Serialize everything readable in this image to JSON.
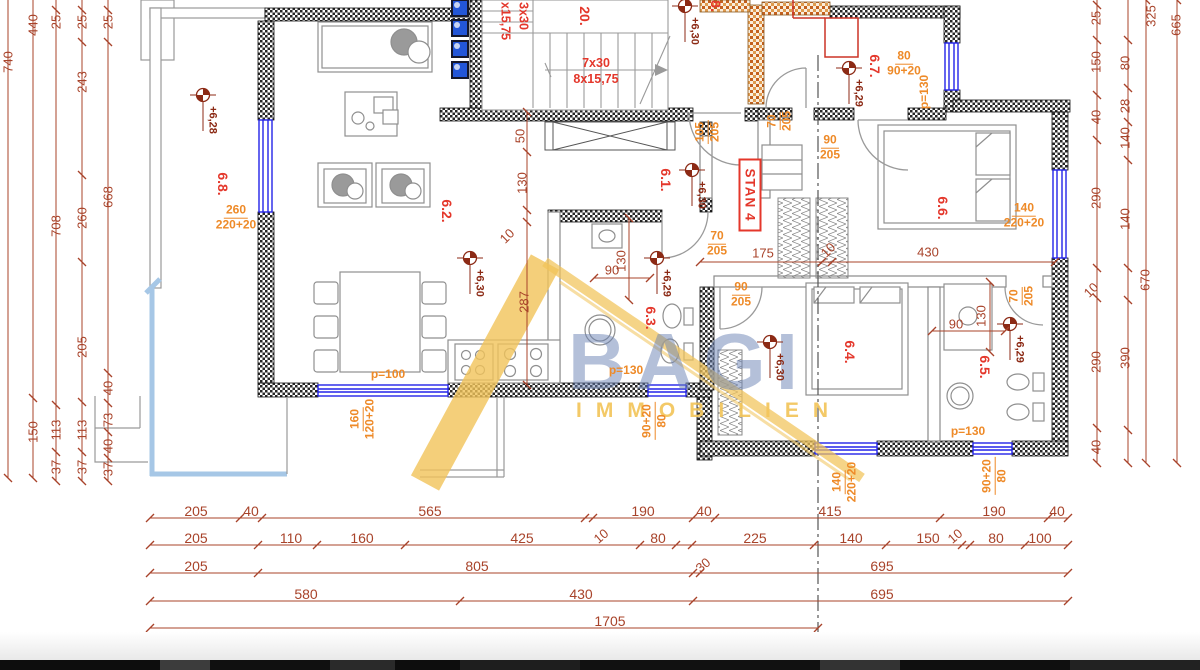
{
  "watermark": {
    "line1": "BAGI",
    "line2": "IMMOBILIEN"
  },
  "apartment_badge": "STAN 4",
  "colors": {
    "dimension": "#a8432a",
    "room_label": "#e4372b",
    "opening_label": "#ee8a28",
    "elevation": "#8c2a15",
    "window": "#2323e8",
    "terrace_edge": "#a6c7e6",
    "watermark_yellow": "#f2c45a",
    "watermark_blue": "#6982b4"
  },
  "plan": {
    "labels": [
      {
        "t": "740",
        "x": 8,
        "y": 62,
        "r": -90,
        "c": "d"
      },
      {
        "t": "440",
        "x": 33,
        "y": 25,
        "r": -90,
        "c": "d"
      },
      {
        "t": "150",
        "x": 33,
        "y": 432,
        "r": -90,
        "c": "d"
      },
      {
        "t": "25",
        "x": 56,
        "y": 22,
        "r": -90,
        "c": "d"
      },
      {
        "t": "708",
        "x": 56,
        "y": 226,
        "r": -90,
        "c": "d"
      },
      {
        "t": "113",
        "x": 56,
        "y": 430,
        "r": -90,
        "c": "d"
      },
      {
        "t": "37",
        "x": 56,
        "y": 467,
        "r": -90,
        "c": "d"
      },
      {
        "t": "25",
        "x": 82,
        "y": 22,
        "r": -90,
        "c": "d"
      },
      {
        "t": "243",
        "x": 82,
        "y": 82,
        "r": -90,
        "c": "d"
      },
      {
        "t": "260",
        "x": 82,
        "y": 218,
        "r": -90,
        "c": "d"
      },
      {
        "t": "205",
        "x": 82,
        "y": 347,
        "r": -90,
        "c": "d"
      },
      {
        "t": "113",
        "x": 82,
        "y": 430,
        "r": -90,
        "c": "d"
      },
      {
        "t": "37",
        "x": 82,
        "y": 467,
        "r": -90,
        "c": "d"
      },
      {
        "t": "25",
        "x": 108,
        "y": 22,
        "r": -90,
        "c": "d"
      },
      {
        "t": "668",
        "x": 108,
        "y": 197,
        "r": -90,
        "c": "d"
      },
      {
        "t": "40",
        "x": 108,
        "y": 388,
        "r": -90,
        "c": "d"
      },
      {
        "t": "73",
        "x": 108,
        "y": 420,
        "r": -90,
        "c": "d"
      },
      {
        "t": "40",
        "x": 108,
        "y": 446,
        "r": -90,
        "c": "d"
      },
      {
        "t": "37",
        "x": 108,
        "y": 469,
        "r": -90,
        "c": "d"
      },
      {
        "t": "50",
        "x": 520,
        "y": 136,
        "r": -90,
        "c": "d"
      },
      {
        "t": "130",
        "x": 522,
        "y": 183,
        "r": -90,
        "c": "d"
      },
      {
        "t": "10",
        "x": 507,
        "y": 236,
        "r": -45,
        "c": "d"
      },
      {
        "t": "287",
        "x": 524,
        "y": 302,
        "r": -90,
        "c": "d"
      },
      {
        "t": "130",
        "x": 621,
        "y": 261,
        "r": -90,
        "c": "d"
      },
      {
        "t": "90",
        "x": 612,
        "y": 270,
        "r": 0,
        "c": "d"
      },
      {
        "t": "175",
        "x": 763,
        "y": 253,
        "r": 0,
        "c": "d"
      },
      {
        "t": "10",
        "x": 828,
        "y": 250,
        "r": -45,
        "c": "d"
      },
      {
        "t": "430",
        "x": 928,
        "y": 252,
        "r": 0,
        "c": "d"
      },
      {
        "t": "90",
        "x": 956,
        "y": 324,
        "r": 0,
        "c": "d"
      },
      {
        "t": "130",
        "x": 981,
        "y": 316,
        "r": -90,
        "c": "d"
      },
      {
        "t": "25",
        "x": 1096,
        "y": 18,
        "r": -90,
        "c": "d"
      },
      {
        "t": "150",
        "x": 1096,
        "y": 62,
        "r": -90,
        "c": "d"
      },
      {
        "t": "40",
        "x": 1096,
        "y": 117,
        "r": -90,
        "c": "d"
      },
      {
        "t": "290",
        "x": 1096,
        "y": 198,
        "r": -90,
        "c": "d"
      },
      {
        "t": "10",
        "x": 1091,
        "y": 290,
        "r": -45,
        "c": "d"
      },
      {
        "t": "290",
        "x": 1096,
        "y": 362,
        "r": -90,
        "c": "d"
      },
      {
        "t": "40",
        "x": 1096,
        "y": 447,
        "r": -90,
        "c": "d"
      },
      {
        "t": "80",
        "x": 1125,
        "y": 63,
        "r": -90,
        "c": "d"
      },
      {
        "t": "28",
        "x": 1125,
        "y": 106,
        "r": -90,
        "c": "d"
      },
      {
        "t": "140",
        "x": 1125,
        "y": 138,
        "r": -90,
        "c": "d"
      },
      {
        "t": "140",
        "x": 1125,
        "y": 219,
        "r": -90,
        "c": "d"
      },
      {
        "t": "390",
        "x": 1125,
        "y": 358,
        "r": -90,
        "c": "d"
      },
      {
        "t": "325",
        "x": 1151,
        "y": 16,
        "r": -90,
        "c": "d"
      },
      {
        "t": "670",
        "x": 1145,
        "y": 280,
        "r": -90,
        "c": "d"
      },
      {
        "t": "665",
        "x": 1176,
        "y": 25,
        "r": -90,
        "c": "d"
      },
      {
        "t": "205",
        "x": 196,
        "y": 511,
        "r": 0,
        "c": "d",
        "f": 14
      },
      {
        "t": "40",
        "x": 251,
        "y": 511,
        "r": 0,
        "c": "d",
        "f": 14
      },
      {
        "t": "565",
        "x": 430,
        "y": 511,
        "r": 0,
        "c": "d",
        "f": 14
      },
      {
        "t": "190",
        "x": 643,
        "y": 511,
        "r": 0,
        "c": "d",
        "f": 14
      },
      {
        "t": "40",
        "x": 704,
        "y": 511,
        "r": 0,
        "c": "d",
        "f": 14
      },
      {
        "t": "415",
        "x": 830,
        "y": 511,
        "r": 0,
        "c": "d",
        "f": 14
      },
      {
        "t": "190",
        "x": 994,
        "y": 511,
        "r": 0,
        "c": "d",
        "f": 14
      },
      {
        "t": "40",
        "x": 1057,
        "y": 511,
        "r": 0,
        "c": "d",
        "f": 14
      },
      {
        "t": "10",
        "x": 601,
        "y": 536,
        "r": -40,
        "c": "d"
      },
      {
        "t": "205",
        "x": 196,
        "y": 538,
        "r": 0,
        "c": "d",
        "f": 14
      },
      {
        "t": "110",
        "x": 291,
        "y": 538,
        "r": 0,
        "c": "d",
        "f": 14
      },
      {
        "t": "160",
        "x": 362,
        "y": 538,
        "r": 0,
        "c": "d",
        "f": 14
      },
      {
        "t": "425",
        "x": 522,
        "y": 538,
        "r": 0,
        "c": "d",
        "f": 14
      },
      {
        "t": "80",
        "x": 658,
        "y": 538,
        "r": 0,
        "c": "d",
        "f": 14
      },
      {
        "t": "225",
        "x": 755,
        "y": 538,
        "r": 0,
        "c": "d",
        "f": 14
      },
      {
        "t": "140",
        "x": 851,
        "y": 538,
        "r": 0,
        "c": "d",
        "f": 14
      },
      {
        "t": "150",
        "x": 928,
        "y": 538,
        "r": 0,
        "c": "d",
        "f": 14
      },
      {
        "t": "80",
        "x": 996,
        "y": 538,
        "r": 0,
        "c": "d",
        "f": 14
      },
      {
        "t": "100",
        "x": 1040,
        "y": 538,
        "r": 0,
        "c": "d",
        "f": 14
      },
      {
        "t": "30",
        "x": 703,
        "y": 565,
        "r": -40,
        "c": "d"
      },
      {
        "t": "10",
        "x": 955,
        "y": 536,
        "r": -40,
        "c": "d"
      },
      {
        "t": "205",
        "x": 196,
        "y": 566,
        "r": 0,
        "c": "d",
        "f": 14
      },
      {
        "t": "805",
        "x": 477,
        "y": 566,
        "r": 0,
        "c": "d",
        "f": 14
      },
      {
        "t": "695",
        "x": 882,
        "y": 566,
        "r": 0,
        "c": "d",
        "f": 14
      },
      {
        "t": "580",
        "x": 306,
        "y": 594,
        "r": 0,
        "c": "d",
        "f": 14
      },
      {
        "t": "430",
        "x": 581,
        "y": 594,
        "r": 0,
        "c": "d",
        "f": 14
      },
      {
        "t": "695",
        "x": 882,
        "y": 594,
        "r": 0,
        "c": "d",
        "f": 14
      },
      {
        "t": "1705",
        "x": 610,
        "y": 621,
        "r": 0,
        "c": "d",
        "f": 14
      },
      {
        "t": "6.8.",
        "x": 223,
        "y": 184,
        "r": 90,
        "c": "r"
      },
      {
        "t": "6.2.",
        "x": 447,
        "y": 211,
        "r": 90,
        "c": "r"
      },
      {
        "t": "6.3.",
        "x": 651,
        "y": 318,
        "r": 90,
        "c": "r"
      },
      {
        "t": "6.1.",
        "x": 666,
        "y": 180,
        "r": 90,
        "c": "r"
      },
      {
        "t": "6.7.",
        "x": 875,
        "y": 66,
        "r": 90,
        "c": "r"
      },
      {
        "t": "6.6.",
        "x": 943,
        "y": 208,
        "r": 90,
        "c": "r"
      },
      {
        "t": "6.4.",
        "x": 850,
        "y": 352,
        "r": 90,
        "c": "r"
      },
      {
        "t": "6.5.",
        "x": 985,
        "y": 367,
        "r": 90,
        "c": "r"
      },
      {
        "t": "20.",
        "x": 585,
        "y": 16,
        "r": 90,
        "c": "r"
      },
      {
        "t": "8.",
        "x": 716,
        "y": 6,
        "r": 90,
        "c": "r"
      },
      {
        "t": "7x30",
        "x": 596,
        "y": 63,
        "r": 0,
        "c": "r",
        "f": 12.5
      },
      {
        "t": "8x15,75",
        "x": 596,
        "y": 79,
        "r": 0,
        "c": "r",
        "f": 12.5
      },
      {
        "t": "3x30",
        "x": 523,
        "y": 16,
        "r": 90,
        "c": "r",
        "f": 12.5
      },
      {
        "t": "x15,75",
        "x": 505,
        "y": 21,
        "r": 90,
        "c": "r",
        "f": 12.5
      },
      {
        "t": "p=100",
        "x": 388,
        "y": 374,
        "r": 0,
        "c": "o"
      },
      {
        "t": "p=130",
        "x": 626,
        "y": 370,
        "r": 0,
        "c": "o"
      },
      {
        "t": "p=130",
        "x": 968,
        "y": 431,
        "r": 0,
        "c": "o"
      },
      {
        "t": "p=130",
        "x": 924,
        "y": 92,
        "r": -90,
        "c": "o"
      }
    ],
    "openings": [
      {
        "a": "260",
        "b": "220+20",
        "x": 236,
        "y": 218,
        "r": 0
      },
      {
        "a": "160",
        "b": "120+20",
        "x": 363,
        "y": 419,
        "r": -90
      },
      {
        "a": "90+20",
        "b": "80",
        "x": 655,
        "y": 421,
        "r": -90
      },
      {
        "a": "140",
        "b": "220+20",
        "x": 845,
        "y": 482,
        "r": -90
      },
      {
        "a": "90+20",
        "b": "80",
        "x": 995,
        "y": 476,
        "r": -90
      },
      {
        "a": "140",
        "b": "220+20",
        "x": 1024,
        "y": 216,
        "r": 0
      },
      {
        "a": "80",
        "b": "90+20",
        "x": 904,
        "y": 64,
        "r": 0
      },
      {
        "a": "105",
        "b": "205",
        "x": 708,
        "y": 132,
        "r": -90
      },
      {
        "a": "70",
        "b": "205",
        "x": 780,
        "y": 121,
        "r": -90
      },
      {
        "a": "90",
        "b": "205",
        "x": 830,
        "y": 148,
        "r": 0
      },
      {
        "a": "70",
        "b": "205",
        "x": 717,
        "y": 244,
        "r": 0
      },
      {
        "a": "90",
        "b": "205",
        "x": 741,
        "y": 295,
        "r": 0
      },
      {
        "a": "70",
        "b": "205",
        "x": 1022,
        "y": 296,
        "r": -90
      }
    ],
    "elevations": [
      {
        "t": "+6,28",
        "x": 203,
        "y": 95
      },
      {
        "t": "+6,30",
        "x": 685,
        "y": 6
      },
      {
        "t": "+6,30",
        "x": 692,
        "y": 170
      },
      {
        "t": "+6,30",
        "x": 470,
        "y": 258
      },
      {
        "t": "+6,29",
        "x": 657,
        "y": 258
      },
      {
        "t": "+6,29",
        "x": 849,
        "y": 68
      },
      {
        "t": "+6,30",
        "x": 770,
        "y": 342
      },
      {
        "t": "+6,29",
        "x": 1010,
        "y": 324
      }
    ],
    "dim_chains": [
      {
        "o": "h",
        "p": 518,
        "a": 150,
        "b": 1068,
        "t": [
          150,
          240,
          262,
          585,
          593,
          693,
          715,
          940,
          1048,
          1068
        ]
      },
      {
        "o": "h",
        "p": 545,
        "a": 150,
        "b": 1068,
        "t": [
          150,
          258,
          317,
          405,
          640,
          676,
          692,
          814,
          886,
          962,
          970,
          1025,
          1068
        ]
      },
      {
        "o": "h",
        "p": 573,
        "a": 150,
        "b": 1068,
        "t": [
          150,
          258,
          693,
          700,
          1068
        ]
      },
      {
        "o": "h",
        "p": 601,
        "a": 150,
        "b": 1068,
        "t": [
          150,
          460,
          693,
          1068
        ]
      },
      {
        "o": "h",
        "p": 628,
        "a": 150,
        "b": 818,
        "t": [
          150,
          818
        ]
      },
      {
        "o": "h",
        "p": 262,
        "a": 700,
        "b": 1055,
        "t": [
          700,
          822,
          832,
          1055
        ]
      },
      {
        "o": "h",
        "p": 278,
        "a": 594,
        "b": 650,
        "t": [
          594,
          650
        ]
      },
      {
        "o": "h",
        "p": 331,
        "a": 932,
        "b": 1005,
        "t": [
          932,
          1005
        ]
      },
      {
        "o": "v",
        "p": 8,
        "a": 0,
        "b": 478,
        "t": [
          478
        ]
      },
      {
        "o": "v",
        "p": 33,
        "a": 0,
        "b": 478,
        "t": [
          398,
          478
        ]
      },
      {
        "o": "v",
        "p": 56,
        "a": 0,
        "b": 481,
        "t": [
          10,
          405,
          452,
          481
        ]
      },
      {
        "o": "v",
        "p": 82,
        "a": 0,
        "b": 481,
        "t": [
          10,
          42,
          175,
          262,
          402,
          452,
          481
        ]
      },
      {
        "o": "v",
        "p": 108,
        "a": 0,
        "b": 481,
        "t": [
          10,
          42,
          373,
          403,
          432,
          458,
          481
        ]
      },
      {
        "o": "v",
        "p": 527,
        "a": 112,
        "b": 385,
        "t": [
          112,
          152,
          210,
          222,
          385
        ]
      },
      {
        "o": "v",
        "p": 629,
        "a": 218,
        "b": 300,
        "t": [
          218,
          300
        ]
      },
      {
        "o": "v",
        "p": 990,
        "a": 282,
        "b": 352,
        "t": [
          282,
          352
        ]
      },
      {
        "o": "v",
        "p": 1097,
        "a": 0,
        "b": 463,
        "t": [
          5,
          40,
          95,
          140,
          268,
          298,
          428,
          463
        ]
      },
      {
        "o": "v",
        "p": 1128,
        "a": 0,
        "b": 463,
        "t": [
          40,
          88,
          122,
          160,
          268,
          300,
          430,
          463
        ]
      },
      {
        "o": "v",
        "p": 1146,
        "a": 0,
        "b": 463,
        "t": [
          0,
          463
        ]
      },
      {
        "o": "v",
        "p": 1177,
        "a": 0,
        "b": 463,
        "t": [
          0,
          463
        ]
      }
    ]
  }
}
